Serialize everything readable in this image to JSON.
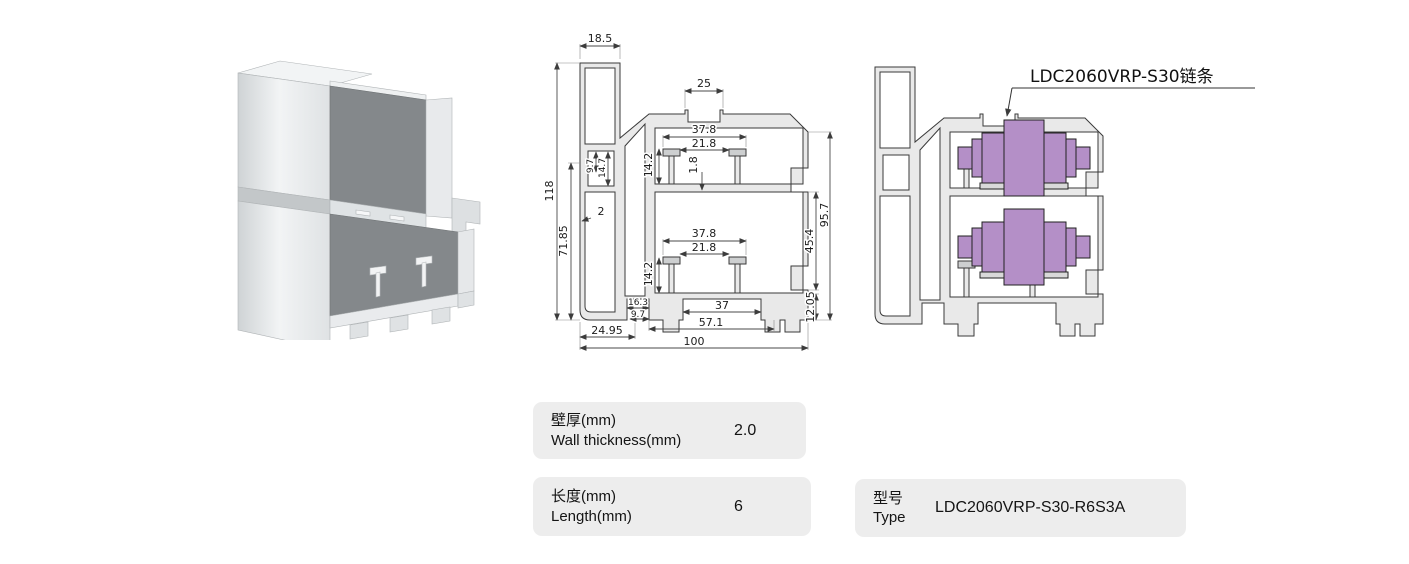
{
  "colors": {
    "chain_purple": "#b48fc7",
    "profile_wall": "#e9e9e9",
    "box_bg": "#ededed",
    "render_dark_face": "#84888b"
  },
  "render3d": {
    "alt": "aluminium profile 3D render"
  },
  "dim_drawing": {
    "dims": {
      "d18_5": "18.5",
      "d25": "25",
      "d37_8_top": "37.8",
      "d21_8_top": "21.8",
      "d14_2_top": "14.2",
      "d1_8": "1.8",
      "d9_7_side": "9.7",
      "d14_7": "14.7",
      "d118": "118",
      "d71_85": "71.85",
      "d2": "2",
      "d37_8_bot": "37.8",
      "d21_8_bot": "21.8",
      "d14_2_bot": "14.2",
      "d95_7": "95.7",
      "d45_4": "45.4",
      "d12_05": "12.05",
      "d16_3": "16.3",
      "d9_7_bottom": "9.7",
      "d37": "37",
      "d57_1": "57.1",
      "d24_95": "24.95",
      "d100": "100"
    }
  },
  "chain_drawing": {
    "label": "LDC2060VRP-S30链条"
  },
  "specs": [
    {
      "label_zh": "壁厚(mm)",
      "label_en": "Wall thickness(mm)",
      "value": "2.0"
    },
    {
      "label_zh": "长度(mm)",
      "label_en": "Length(mm)",
      "value": "6"
    },
    {
      "label_zh": "型号",
      "label_en": "Type",
      "value": "LDC2060VRP-S30-R6S3A"
    }
  ]
}
